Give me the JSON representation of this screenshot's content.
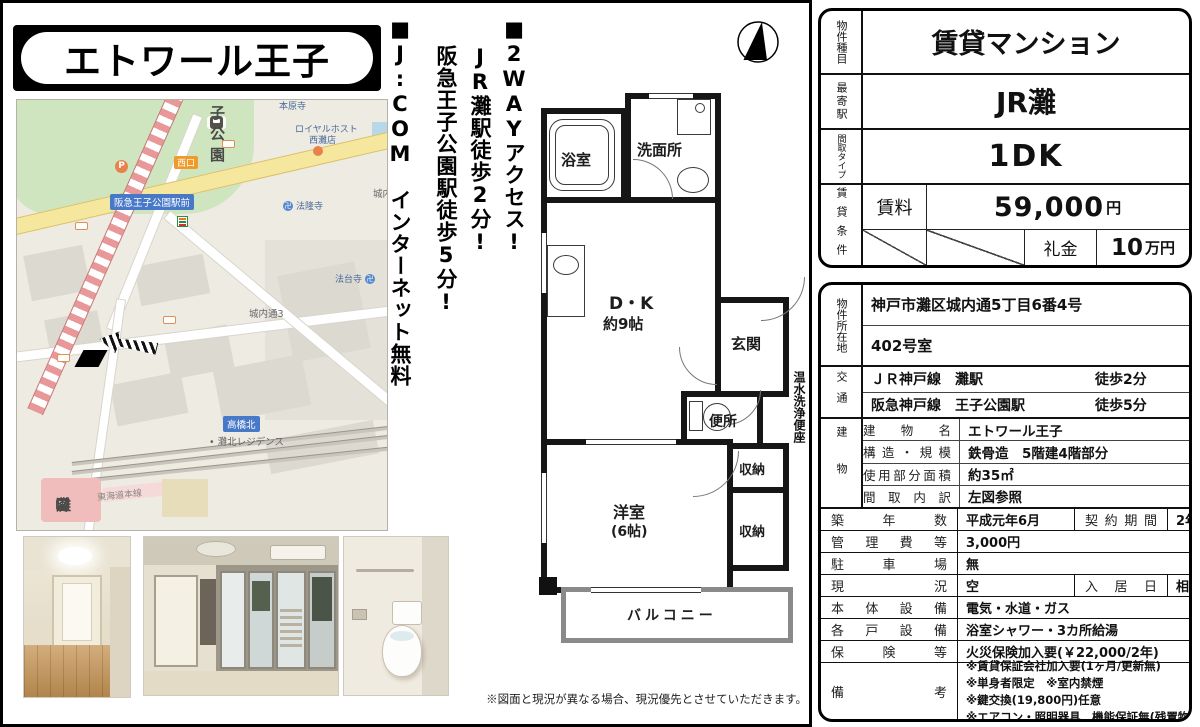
{
  "title": "エトワール王子",
  "points": {
    "p1": "■2WAYアクセス!",
    "p2": "JR灘駅徒歩2分!",
    "p3": "阪急王子公園駅徒歩5分!",
    "p4": "■J:COM　インターネット無料"
  },
  "plan": {
    "bath": "浴室",
    "washroom": "洗面所",
    "dk": "D・K",
    "dk_size": "約9帖",
    "entrance": "玄関",
    "toilet": "便所",
    "storage1": "収納",
    "storage2": "収納",
    "western": "洋室",
    "western_size": "(6帖)",
    "balcony": "バルコニー",
    "side_note": "温水洗浄便座"
  },
  "map": {
    "station_top": "王子公園",
    "temple_top": "本原寺",
    "restaurant1": "ロイヤルホスト",
    "restaurant2": "西灘店",
    "west_exit": "西口",
    "ekimae": "阪急王子公園駅前",
    "temple1": "法隆寺",
    "temple2": "法台寺",
    "temple_icon": "卍",
    "parking": "P",
    "district": "城内通3",
    "district_right": "城内",
    "crossing": "高橋北",
    "residence": "灘北レジデンス",
    "rail_line": "東海道本線",
    "station_bottom": "灘"
  },
  "disclaimer": "※図面と現況が異なる場合、現況優先とさせていただきます。",
  "summary": {
    "type_label": "物件種目",
    "type": "賃貸マンション",
    "station_label": "最寄駅",
    "station": "JR灘",
    "layout_label": "間取タイプ",
    "layout": "1DK",
    "cond_label": "賃貸条件",
    "rent_label": "賃料",
    "rent": "59,000",
    "rent_unit": "円",
    "key_label": "礼金",
    "key": "10",
    "key_unit": "万円"
  },
  "details": {
    "loc_label": "物件所在地",
    "addr1": "神戸市灘区城内通5丁目6番4号",
    "addr2": "402号室",
    "access_label": "交通",
    "acc1_line": "ＪＲ神戸線　灘駅",
    "acc1_walk": "徒歩2分",
    "acc2_line": "阪急神戸線　王子公園駅",
    "acc2_walk": "徒歩5分",
    "bld_label": "建物",
    "bld_rows": [
      {
        "label": "建物名",
        "value": "エトワール王子"
      },
      {
        "label": "構造・規模",
        "value": "鉄骨造　5階建4階部分"
      },
      {
        "label": "使用部分面積",
        "value": "約35㎡"
      },
      {
        "label": "間取内訳",
        "value": "左図参照"
      }
    ],
    "rows": [
      {
        "label": "築年数",
        "value": "平成元年6月",
        "label2": "契約期間",
        "value2": "2年"
      },
      {
        "label": "管理費等",
        "value": "3,000円"
      },
      {
        "label": "駐車場",
        "value": "無"
      },
      {
        "label": "現況",
        "value": "空",
        "label2": "入居日",
        "value2": "相談"
      },
      {
        "label": "本体設備",
        "value": "電気・水道・ガス"
      },
      {
        "label": "各戸設備",
        "value": "浴室シャワー・3カ所給湯"
      },
      {
        "label": "保険等",
        "value": "火災保険加入要(￥22,000/2年)"
      }
    ],
    "remarks_label": "備考",
    "remarks": [
      "※賃貸保証会社加入要(1ヶ月/更新無)",
      "※単身者限定　※室内禁煙",
      "※鍵交換(19,800円)任意",
      "※エアコン・照明器具　機能保証無(残置物)"
    ]
  }
}
